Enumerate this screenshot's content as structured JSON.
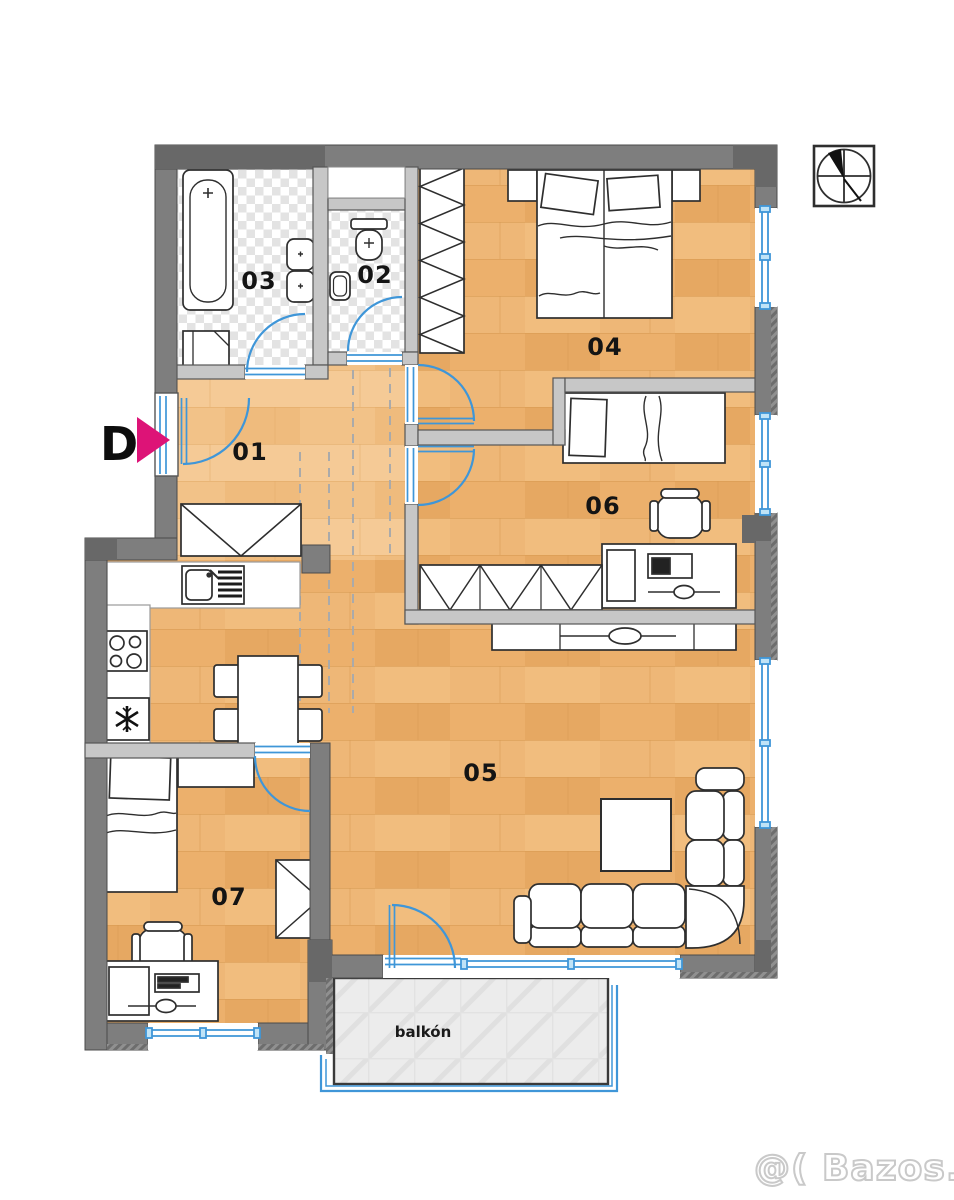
{
  "plan": {
    "type": "apartment-floor-plan",
    "room_labels": {
      "r01": "01",
      "r02": "02",
      "r03": "03",
      "r04": "04",
      "r05": "05",
      "r06": "06",
      "r07": "07"
    },
    "balcony_label": "balkón",
    "entrance_marker": "D"
  },
  "watermark": "@( Bazos.sk",
  "colors": {
    "wood_floor": "#ecb06c",
    "wood_floor_light": "#f2c288",
    "tile_floor": "#e3e3e3",
    "balcony_floor": "#ececec",
    "exterior_wall": "#7e7e7e",
    "interior_wall": "#c7c7c7",
    "wall_outline": "#4b4b4b",
    "door_window_blue": "#3f96d8",
    "entrance_arrow_pink": "#dd1377",
    "furniture_outline": "#2e2e2e",
    "label_text": "#141414",
    "watermark_gray": "#c9c9c9"
  }
}
